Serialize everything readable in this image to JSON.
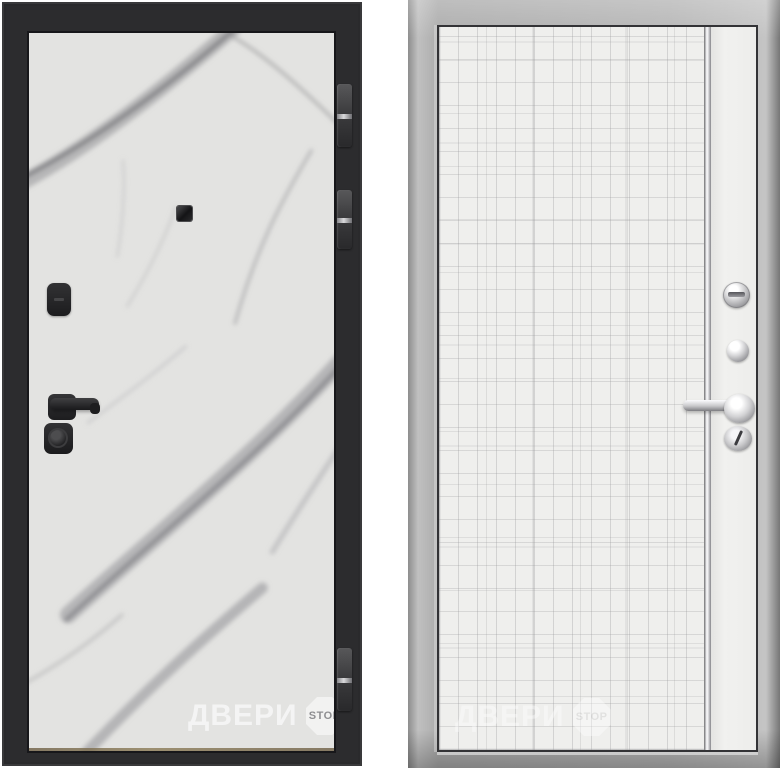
{
  "watermark": {
    "brand": "ДВЕРИ",
    "badge": "STOP"
  },
  "left_door": {
    "frame_color": "#2c2c2e",
    "panel_color": "#e3e3e1",
    "vein_color": "#8e8e92",
    "hardware_color": "#1f1f21",
    "hinge_band_color": "#d9d9db",
    "hardware": [
      "peephole-icon",
      "lock-cover-icon",
      "lever-handle-icon",
      "cylinder-lock-icon"
    ],
    "hinge_count": 3
  },
  "right_door": {
    "frame_color": "#b2b2b2",
    "panel_color": "#efefed",
    "line_color": "#c6c6c8",
    "hardware_color": "#c9c9cb",
    "hardware": [
      "thumb-turn-icon",
      "knob-icon",
      "lever-handle-icon",
      "keyhole-icon"
    ]
  }
}
